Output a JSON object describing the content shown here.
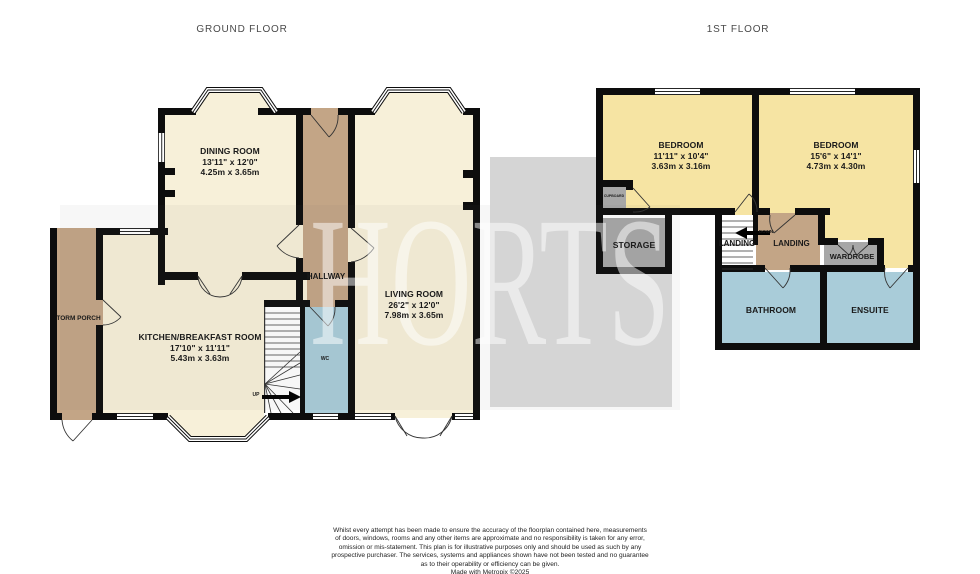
{
  "titles": {
    "ground_floor": "GROUND FLOOR",
    "first_floor": "1ST FLOOR"
  },
  "watermark": {
    "text": "HORTS"
  },
  "palette": {
    "wall": "#0d0d0d",
    "cream": "#F7F0D9",
    "brown": "#C3A586",
    "blue": "#A9CCD9",
    "yellow": "#F6E4A3",
    "gray_room": "#A7A7A7",
    "watermark_gray": "#D5D5D5",
    "title_text": "#4a4a4a",
    "label_text": "#1a1a1a"
  },
  "ground_floor": {
    "dining_room": {
      "name": "DINING ROOM",
      "imperial": "13'11\" x 12'0\"",
      "metric": "4.25m x 3.65m"
    },
    "kitchen": {
      "name": "KITCHEN/BREAKFAST ROOM",
      "imperial": "17'10\" x 11'11\"",
      "metric": "5.43m x 3.63m"
    },
    "living_room": {
      "name": "LIVING ROOM",
      "imperial": "26'2\" x 12'0\"",
      "metric": "7.98m x 3.65m"
    },
    "hallway": {
      "name": "HALLWAY"
    },
    "wc": {
      "name": "WC"
    },
    "storm_porch": {
      "name": "STORM PORCH"
    },
    "stairs": {
      "direction": "UP"
    }
  },
  "first_floor": {
    "bedroom_1": {
      "name": "BEDROOM",
      "imperial": "11'11\" x 10'4\"",
      "metric": "3.63m x 3.16m"
    },
    "bedroom_2": {
      "name": "BEDROOM",
      "imperial": "15'6\" x 14'1\"",
      "metric": "4.73m x 4.30m"
    },
    "storage": {
      "name": "STORAGE"
    },
    "landing_over_stairs": {
      "name": "LANDING"
    },
    "landing": {
      "name": "LANDING"
    },
    "wardrobe": {
      "name": "WARDROBE"
    },
    "bathroom": {
      "name": "BATHROOM"
    },
    "ensuite": {
      "name": "ENSUITE"
    },
    "cupboard": {
      "name": "CUPBOARD"
    },
    "stairs": {
      "direction": "DOWN"
    }
  },
  "footer": {
    "disclaimer": "Whilst every attempt has been made to ensure the accuracy of the floorplan contained here, measurements\nof doors, windows, rooms and any other items are approximate and no responsibility is taken for any error,\nomission or mis-statement. This plan is for illustrative purposes only and should be used as such by any\nprospective purchaser. The services, systems and appliances shown have not been tested and no guarantee\nas to their operability or efficiency can be given.",
    "credit": "Made with Metropix ©2025"
  }
}
